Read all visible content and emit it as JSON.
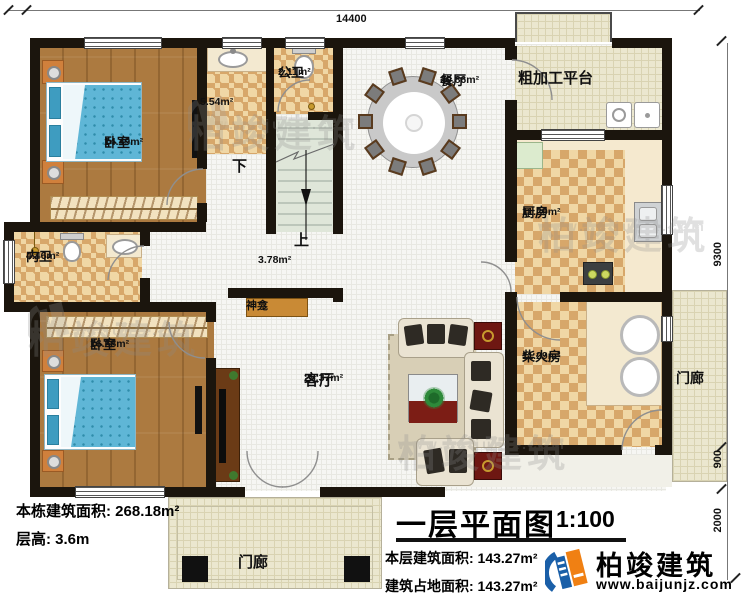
{
  "dimensions": {
    "top": "14400",
    "right1": "9300",
    "right2": "900",
    "right3": "2000"
  },
  "rooms": {
    "bedroom1": {
      "name": "卧室",
      "area": "14.49m²"
    },
    "wash": {
      "area": "5.54m²"
    },
    "public_bath": {
      "name": "公卫",
      "area": "2.11m²"
    },
    "dining": {
      "name": "餐厅",
      "area": "20.86m²"
    },
    "platform": {
      "name": "粗加工平台"
    },
    "kitchen": {
      "name": "厨房",
      "area": "11.29m²"
    },
    "inner_bath": {
      "name": "内卫",
      "area": "4.46m²"
    },
    "bedroom2": {
      "name": "卧室",
      "area": "16.58m²"
    },
    "living": {
      "name": "客厅",
      "area": "28.37m²"
    },
    "firewood": {
      "name": "柴火房",
      "area": "11.29m²"
    },
    "hall": {
      "area": "3.78m²"
    },
    "shrine": {
      "name": "神龛"
    },
    "porch_bottom": {
      "name": "门廊"
    },
    "porch_right": {
      "name": "门廊"
    }
  },
  "stairs": {
    "down": "下",
    "up": "上"
  },
  "info": {
    "line1": "本栋建筑面积: 268.18m²",
    "line2": "层高: 3.6m"
  },
  "title_block": {
    "title": "一层平面图",
    "scale": "1:100",
    "line1": "本层建筑面积: 143.27m²",
    "line2": "建筑占地面积: 143.27m²"
  },
  "brand": {
    "name": "柏竣建筑",
    "url": "www.baijunjz.com"
  },
  "watermark": {
    "name": "柏竣建筑",
    "url": "www.baijunjz.com"
  },
  "colors": {
    "brand_blue": "#1a5fa8",
    "brand_orange": "#f08013",
    "wall": "#1b150d",
    "wood_floor": "#ac7a40",
    "tile": "#d7a76a",
    "paving": "#ebe7cf",
    "bed": "#5fb6d6"
  }
}
